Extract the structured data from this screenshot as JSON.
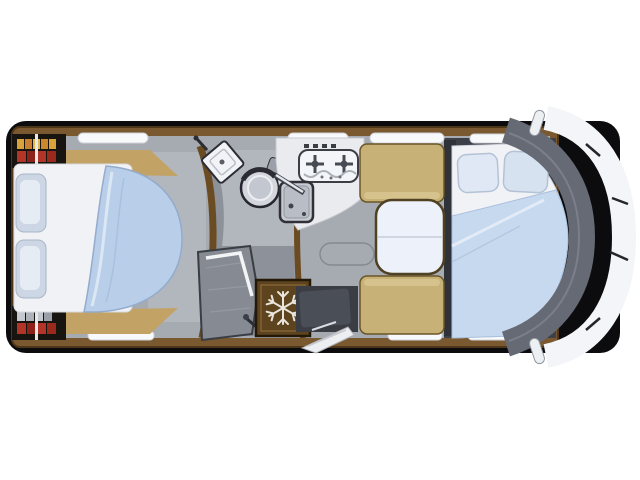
{
  "scene": {
    "kind": "motorhome-floorplan-top-view",
    "front_direction": "right"
  },
  "palette": {
    "page_bg": "#ffffff",
    "body_black": "#0c0c0f",
    "cab_white": "#f3f5f8",
    "windshield": "#666a75",
    "wood": "#7a5830",
    "wood_dark": "#4e3718",
    "floor": "#a6aab1",
    "floor_light": "#b2b6bd",
    "corridor": "#8d9199",
    "bathroom_floor": "#b2b6bd",
    "mattress": "#f0f2f6",
    "bedding": "#b9cfe9",
    "bedding_front": "#c7d9ee",
    "pillow": "#ccd6e4",
    "upholstery": "#c8b176",
    "upholstery_light": "#d6c28c",
    "table_top": "#edf1f9",
    "counter": "#e9ebef",
    "hob_white": "#f4f5f8",
    "appliance_dark": "#3a3d44",
    "fridge": "#5d431e",
    "snowflake": "#e9e5da",
    "shower": "#858a93",
    "window": "#f8f9fb",
    "shelf_dark": "#181410",
    "books_yellow": "#d9a33a",
    "books_red": "#b23527",
    "mirror": "#edf0f3",
    "platform_dark": "#3d4048",
    "entry_dark": "#3a3d44",
    "step_white": "#eceef1"
  },
  "icons": [
    "snowflake-icon",
    "hob-burner-icon",
    "faucet-icon",
    "toilet-icon",
    "washbasin-icon",
    "shower-door-icon",
    "mirror-icon"
  ],
  "features": [
    "rear-island-bed",
    "rear-wardrobe-shelves",
    "washroom-toilet",
    "washroom-basin",
    "shower-cubicle",
    "refrigerator",
    "kitchen-hob",
    "kitchen-sink",
    "dinette-benches",
    "dinette-table",
    "entry-door-step",
    "front-drop-down-bed",
    "cab-windshield",
    "side-mirrors",
    "windows"
  ]
}
